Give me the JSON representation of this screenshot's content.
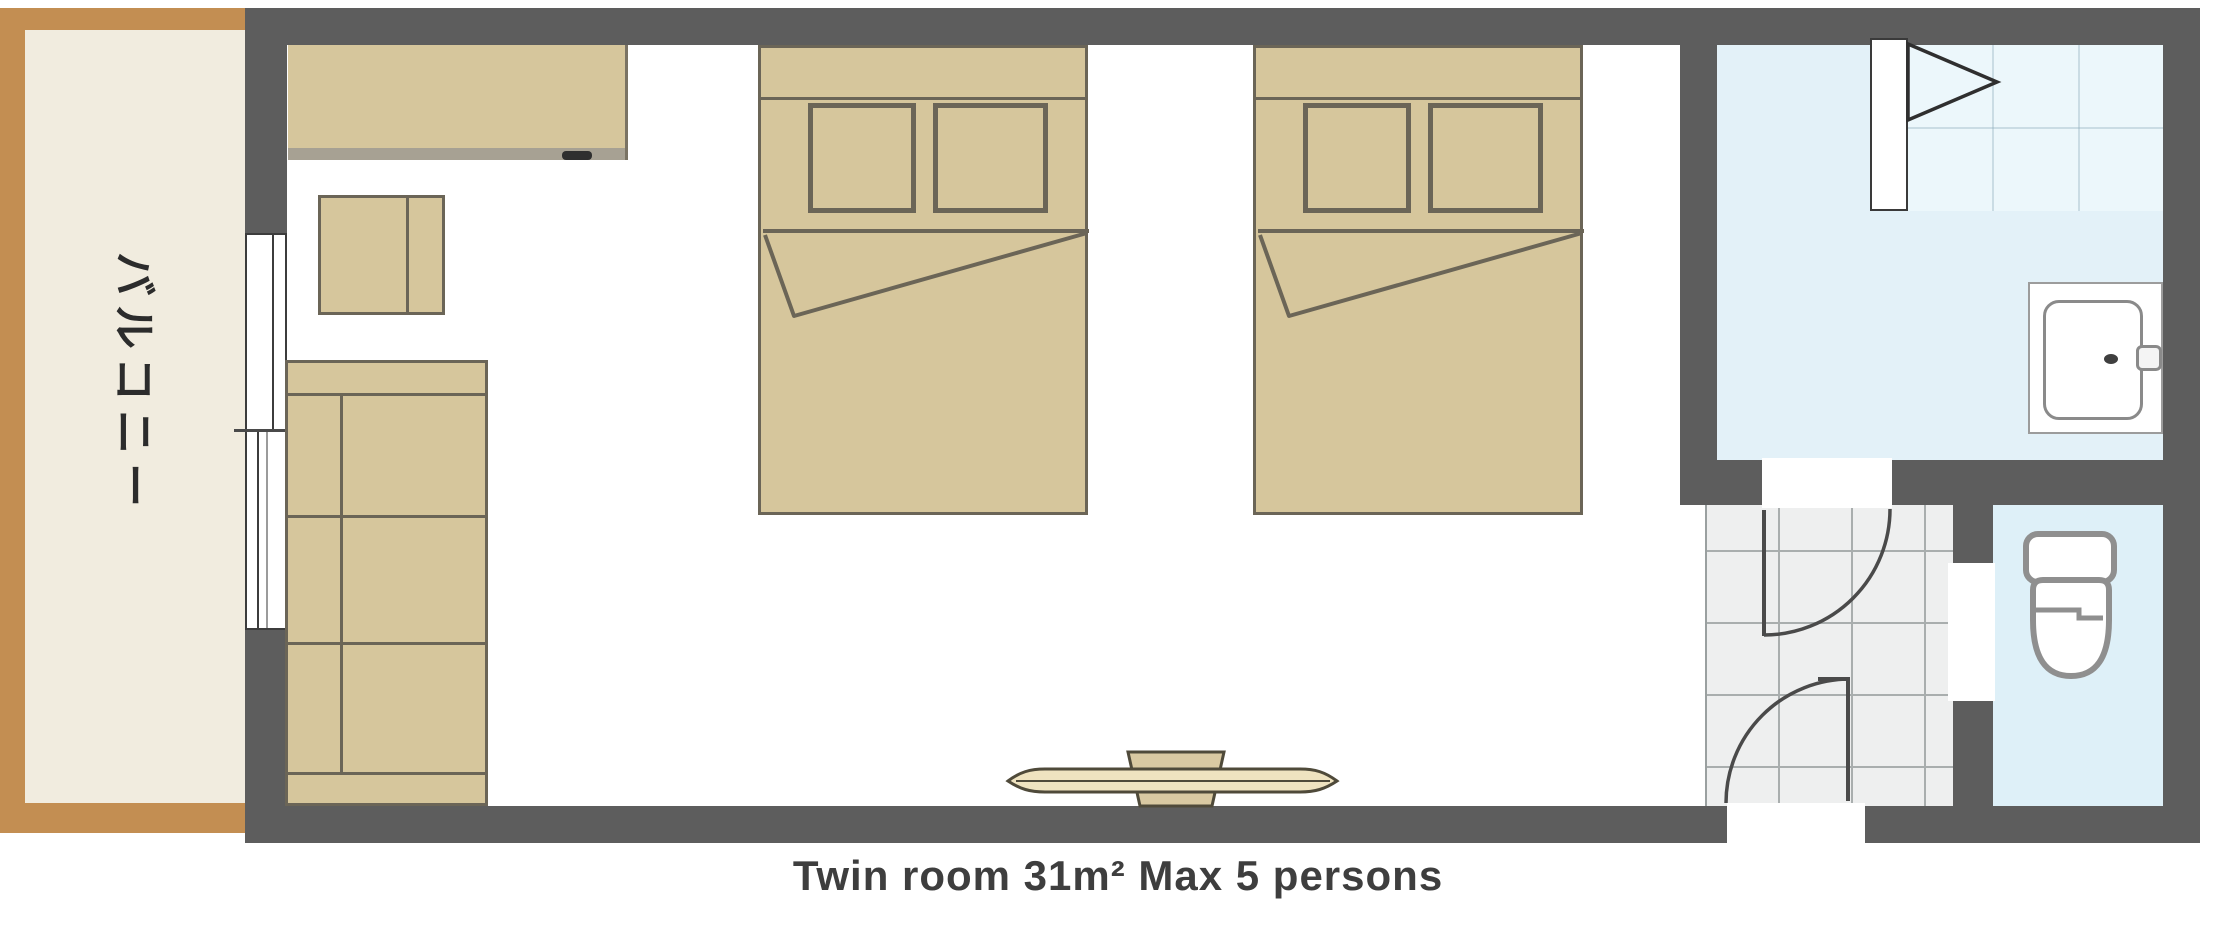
{
  "caption": "Twin room 31m² Max 5 persons",
  "balcony": {
    "label": "バルコニー"
  },
  "palette": {
    "wall": "#5d5d5d",
    "furniture_fill": "#d6c69c",
    "furniture_outline": "#6b6557",
    "balcony_border": "#c38e52",
    "balcony_floor": "#f1ecdf",
    "washroom_floor": "#e3f1f8",
    "bath_floor": "#ecf7fb",
    "toilet_floor": "#def0f8",
    "entry_tile_floor": "#eeefef",
    "caption_color": "#3e3e3e"
  }
}
